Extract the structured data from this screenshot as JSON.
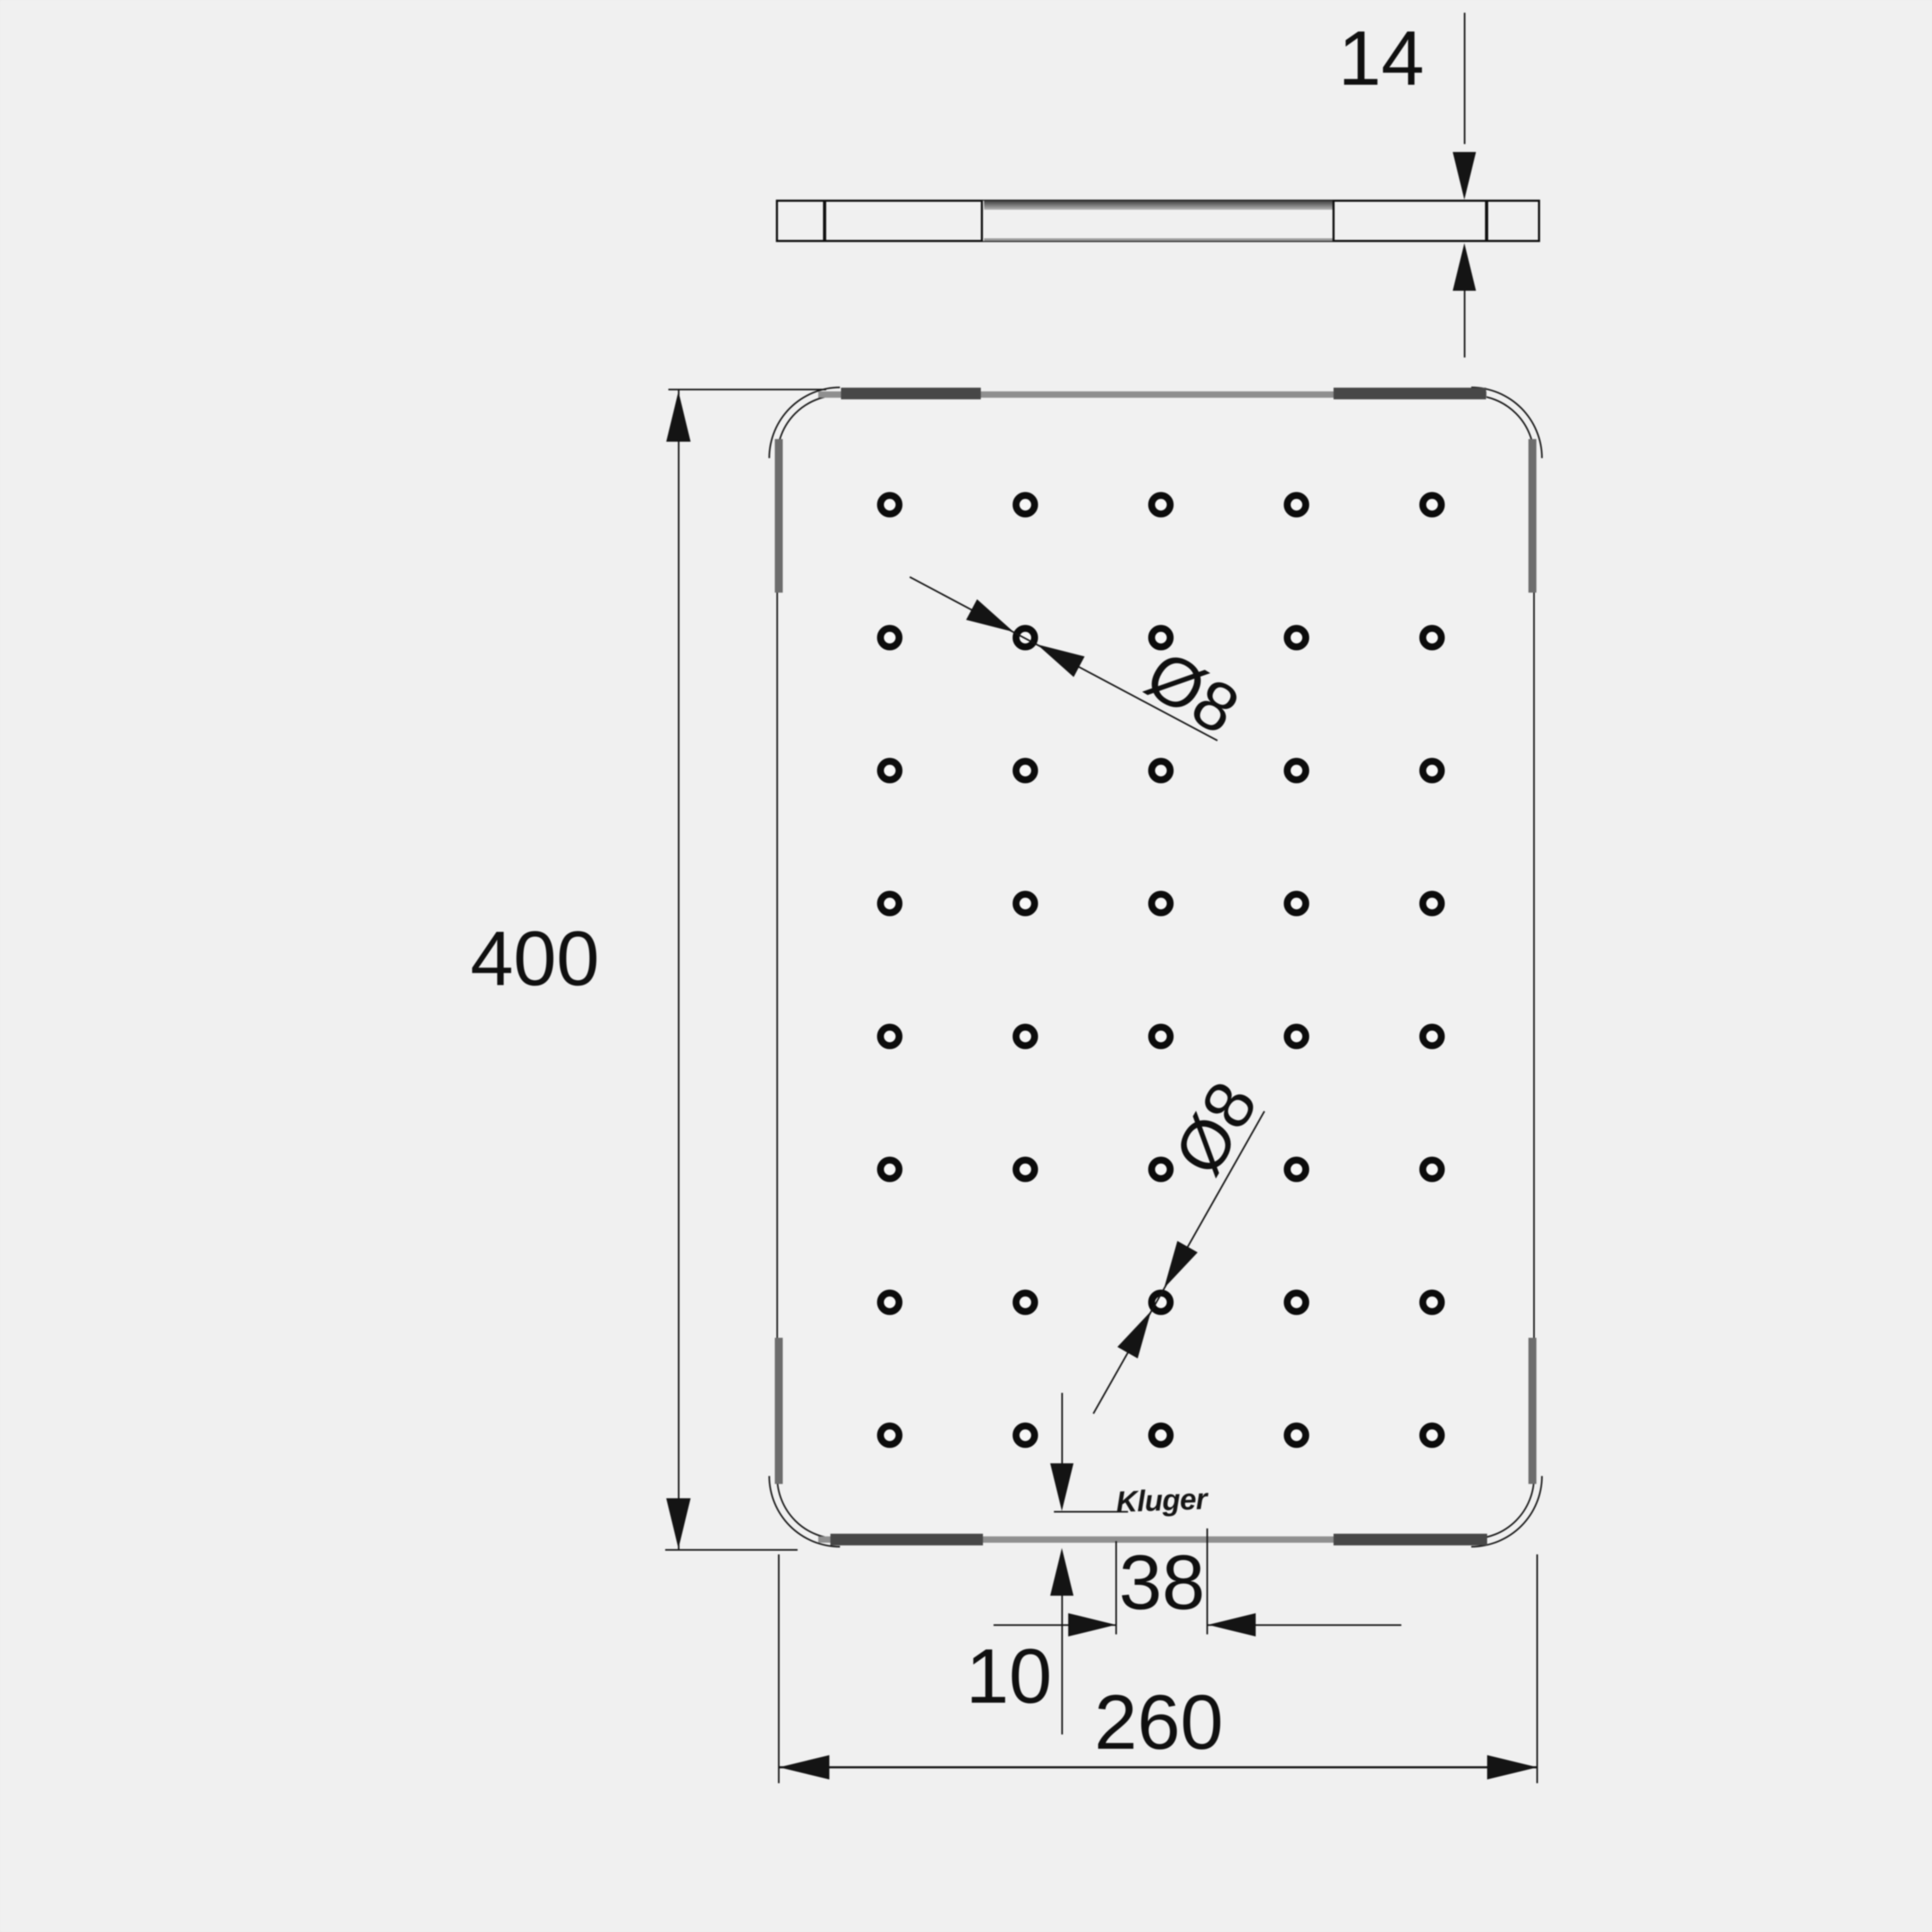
{
  "drawing": {
    "type": "technical-drawing",
    "background": "#f0f0f0",
    "line_color": "#141414",
    "rail_dark_color": "#474747",
    "rail_light_color": "#8f8f8f",
    "brand": "Kluger",
    "dimensions": {
      "thickness": "14",
      "height": "400",
      "width": "260",
      "edge_offset": "10",
      "hole_edge_distance": "38",
      "hole_diameter_top": "Ø8",
      "hole_diameter_bottom": "Ø8"
    },
    "holes": {
      "rows": 8,
      "cols": 5
    }
  }
}
